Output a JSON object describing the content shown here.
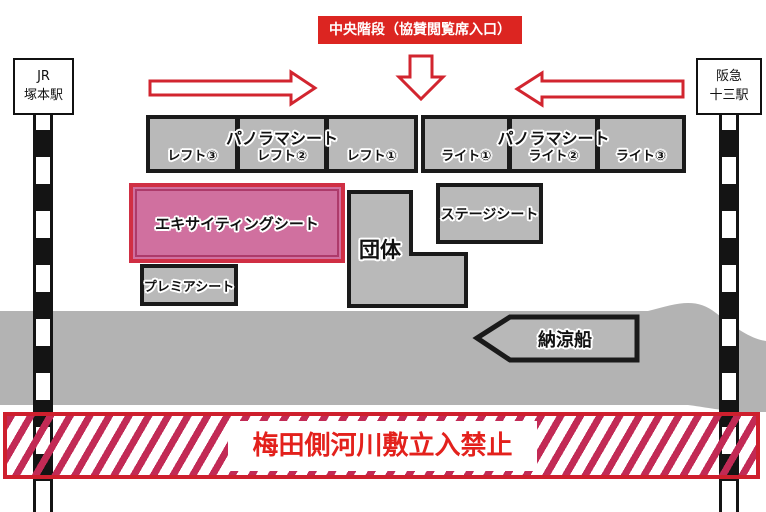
{
  "header": {
    "banner": "中央階段（協賛閲覧席入口）"
  },
  "stations": {
    "left": {
      "line1": "JR",
      "line2": "塚本駅"
    },
    "right": {
      "line1": "阪急",
      "line2": "十三駅"
    }
  },
  "panorama_left": {
    "title": "パノラマシート",
    "cells": [
      "レフト③",
      "レフト②",
      "レフト①"
    ]
  },
  "panorama_right": {
    "title": "パノラマシート",
    "cells": [
      "ライト①",
      "ライト②",
      "ライト③"
    ]
  },
  "seats": {
    "exciting": "エキサイティングシート",
    "group": "団体",
    "stage": "ステージシート",
    "premium": "プレミアシート"
  },
  "river": {
    "boat": "納涼船"
  },
  "restricted": {
    "label": "梅田側河川敷立入禁止"
  },
  "colors": {
    "accent_red": "#d2252f",
    "banner_red": "#dc2521",
    "stripe_red": "#c22a55",
    "band_border_red": "#ce1f2d",
    "warning_text_red": "#e3211c",
    "exciting_pink": "#d0709f",
    "exciting_inner_border": "#ad3a6a",
    "seat_gray": "#b9b9b9",
    "river_gray": "#b3b3b3",
    "outline_black": "#1a1a1a"
  }
}
